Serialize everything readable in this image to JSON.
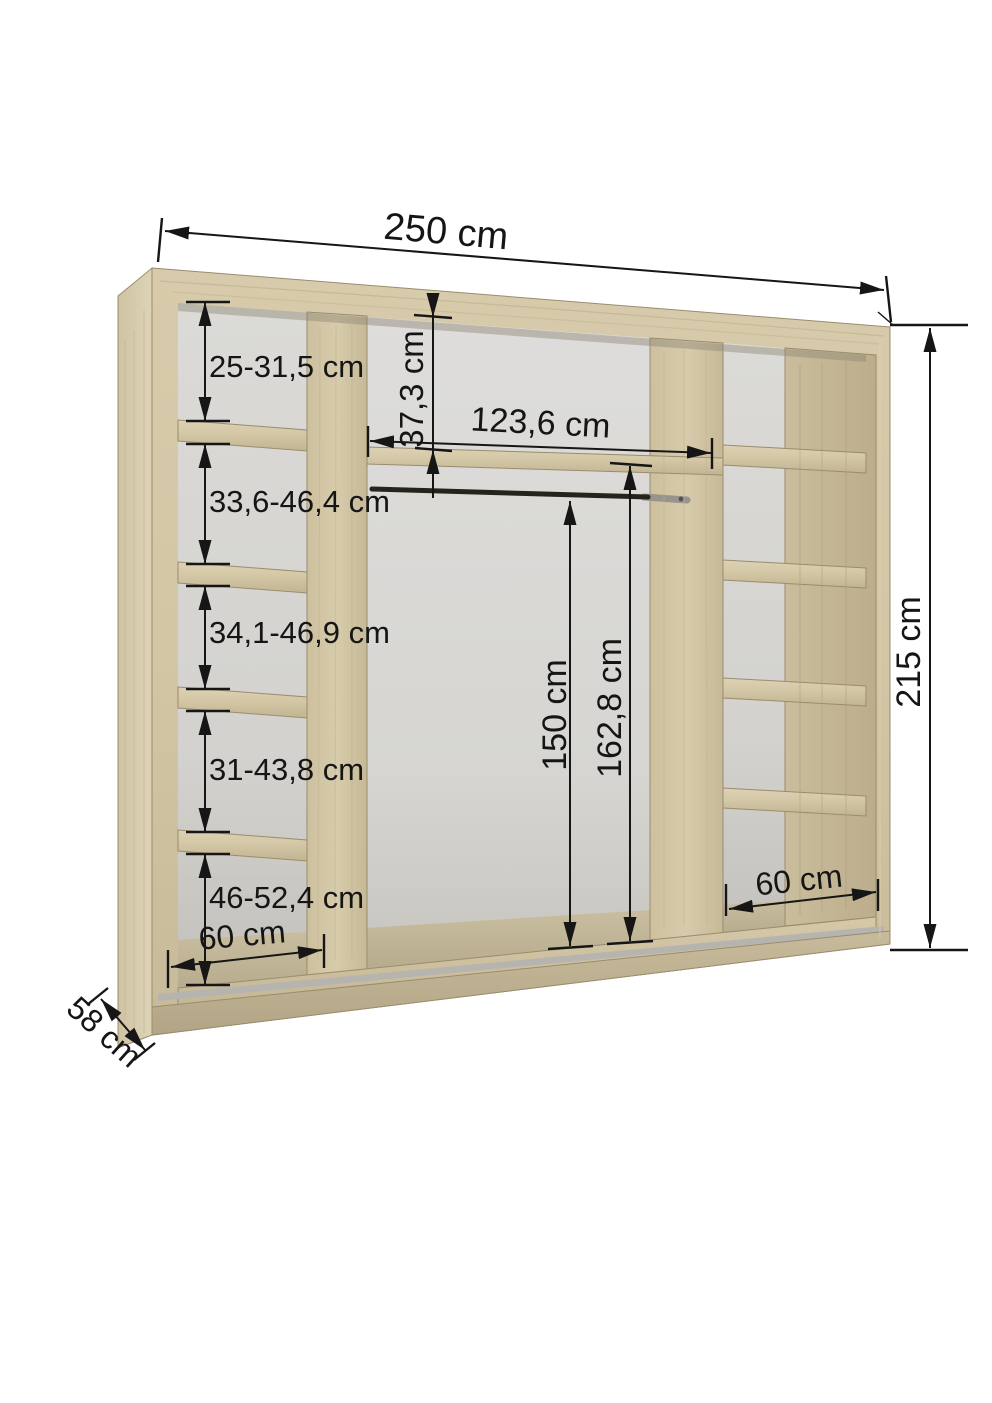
{
  "diagram": {
    "type": "furniture-dimension-diagram",
    "subject": "wardrobe-interior",
    "unit": "cm",
    "dims": {
      "total_width": "250 cm",
      "total_height": "215 cm",
      "depth": "58 cm",
      "left_column": {
        "sections": [
          "25-31,5 cm",
          "33,6-46,4 cm",
          "34,1-46,9 cm",
          "31-43,8 cm",
          "46-52,4 cm"
        ],
        "bottom_width": "60 cm"
      },
      "middle": {
        "top_shelf_gap": "37,3 cm",
        "opening_width": "123,6 cm",
        "rail_to_floor": "150 cm",
        "shelf_to_floor": "162,8 cm"
      },
      "right_column": {
        "bottom_width": "60 cm"
      }
    },
    "colors": {
      "background": "#ffffff",
      "wood_light": "#d8cdad",
      "wood_mid": "#cfc3a2",
      "wood_dark": "#b9ab8a",
      "back_panel": "#d8d7d3",
      "floor_surface": "#c2b698",
      "rail_strip": "#b6b4af",
      "dimension_lines": "#161616"
    }
  }
}
